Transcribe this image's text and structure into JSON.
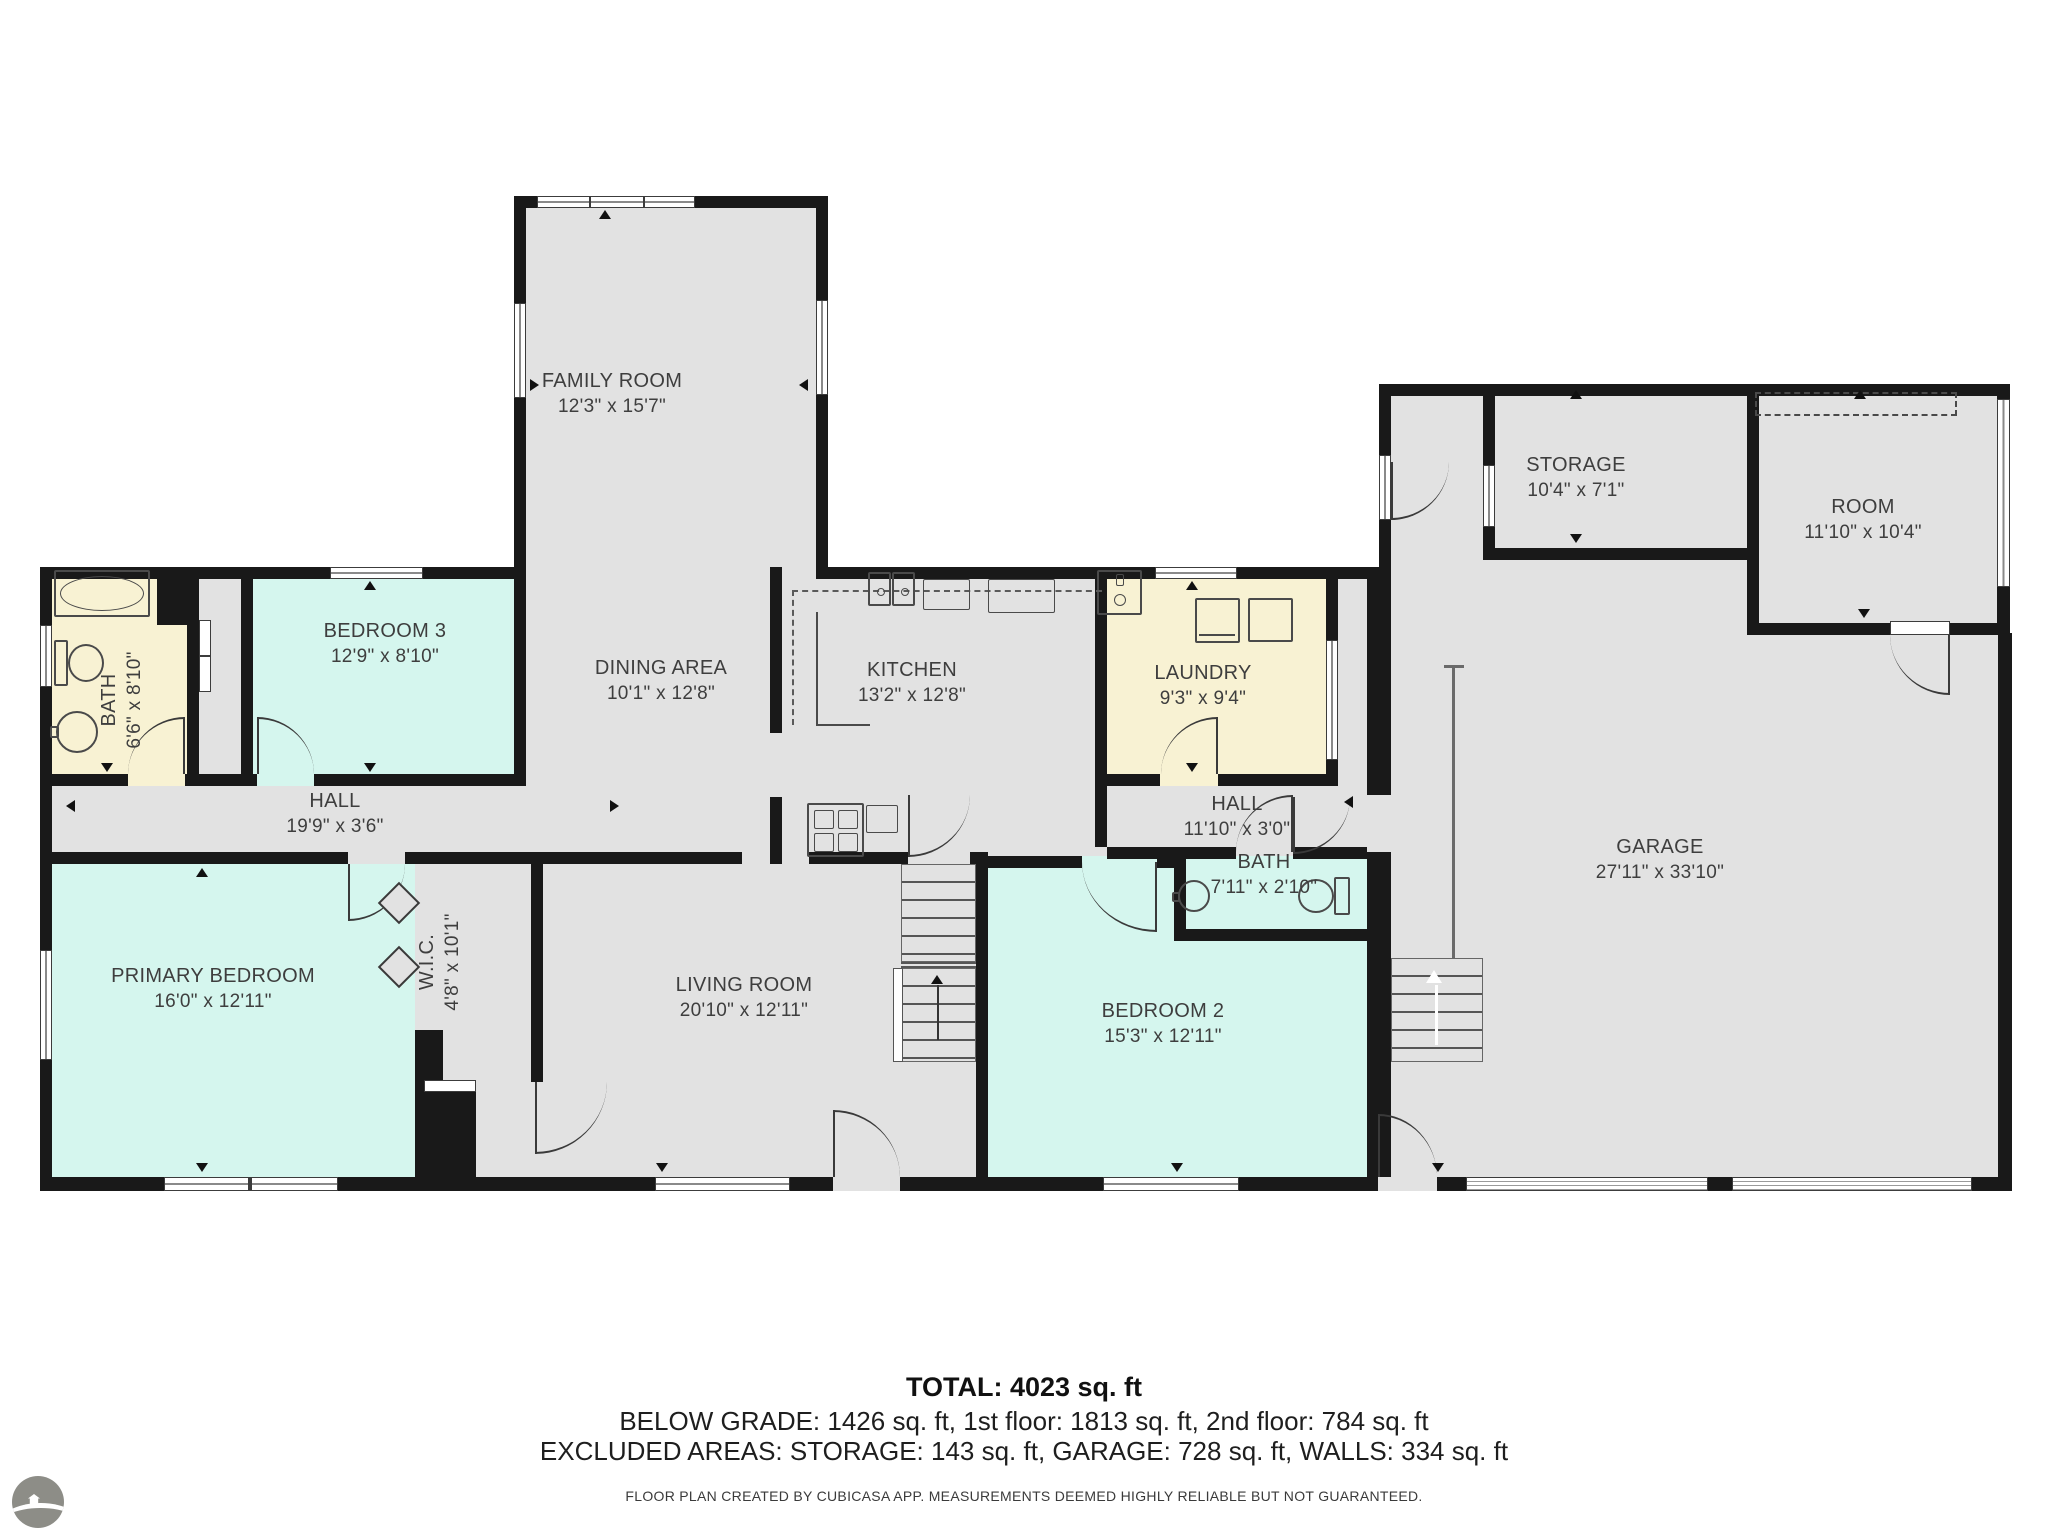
{
  "rooms": [
    {
      "name": "FAMILY ROOM",
      "dims": "12'3\" x 15'7\""
    },
    {
      "name": "STORAGE",
      "dims": "10'4\" x 7'1\""
    },
    {
      "name": "ROOM",
      "dims": "11'10\" x 10'4\""
    },
    {
      "name": "BATH",
      "dims": "6'6\" x 8'10\""
    },
    {
      "name": "BEDROOM 3",
      "dims": "12'9\" x 8'10\""
    },
    {
      "name": "DINING AREA",
      "dims": "10'1\" x 12'8\""
    },
    {
      "name": "KITCHEN",
      "dims": "13'2\" x 12'8\""
    },
    {
      "name": "LAUNDRY",
      "dims": "9'3\" x 9'4\""
    },
    {
      "name": "HALL",
      "dims": "19'9\" x 3'6\""
    },
    {
      "name": "HALL",
      "dims": "11'10\" x 3'0\""
    },
    {
      "name": "BATH",
      "dims": "7'11\" x 2'10\""
    },
    {
      "name": "PRIMARY BEDROOM",
      "dims": "16'0\" x 12'11\""
    },
    {
      "name": "W.I.C.",
      "dims": "4'8\" x 10'1\""
    },
    {
      "name": "LIVING ROOM",
      "dims": "20'10\" x 12'11\""
    },
    {
      "name": "BEDROOM 2",
      "dims": "15'3\" x 12'11\""
    },
    {
      "name": "GARAGE",
      "dims": "27'11\" x 33'10\""
    }
  ],
  "footer": {
    "total": "TOTAL: 4023 sq. ft",
    "floors": "BELOW GRADE: 1426 sq. ft, 1st floor: 1813 sq. ft, 2nd floor: 784 sq. ft",
    "excluded": "EXCLUDED AREAS: STORAGE: 143 sq. ft, GARAGE: 728 sq. ft, WALLS: 334 sq. ft",
    "disclaimer": "FLOOR PLAN CREATED BY CUBICASA APP. MEASUREMENTS DEEMED HIGHLY RELIABLE BUT NOT GUARANTEED."
  },
  "colors": {
    "wall": "#191919",
    "floor": "#e2e2e2",
    "bedroom": "#d5f6ee",
    "wet": "#f8f2d3"
  }
}
